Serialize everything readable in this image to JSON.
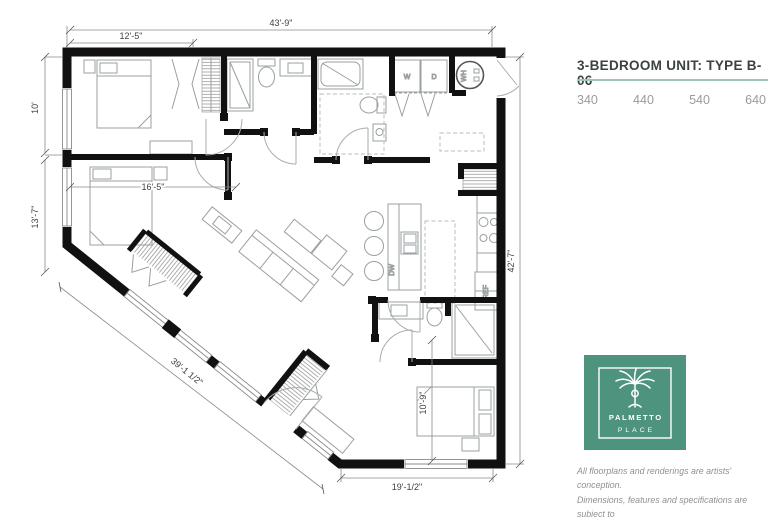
{
  "header": {
    "title": "3-BEDROOM UNIT: TYPE B-06",
    "unit_numbers": [
      "340",
      "440",
      "540",
      "640"
    ]
  },
  "floorplan": {
    "dimensions": {
      "overall_width": "43'-9\"",
      "bed1_width": "12'-5\"",
      "bed1_depth": "10'",
      "left_lower": "13'-7\"",
      "bed2_width": "16'-5\"",
      "diagonal_wall": "39'-1 1/2\"",
      "bottom_width": "19'-1/2\"",
      "overall_depth": "42'-7\"",
      "bed3_width": "10'-9\""
    },
    "appliances": {
      "washer": "W",
      "dryer": "D",
      "water_heater": "WH",
      "dishwasher": "DW",
      "refrigerator": "REF"
    }
  },
  "logo": {
    "line1": "PALMETTO",
    "line2": "PLACE"
  },
  "disclaimer": {
    "line1": "All floorplans and renderings are artists' conception.",
    "line2": "Dimensions, features and specifications are subject to",
    "line3": "change at the discretion of the builder."
  },
  "colors": {
    "accent_teal": "#4E937E",
    "rule_teal": "#9CC8B8",
    "title_text": "#3B4240",
    "muted_text": "#9B9B9B",
    "wall": "#111111",
    "line_gray": "#9AA0A0"
  }
}
